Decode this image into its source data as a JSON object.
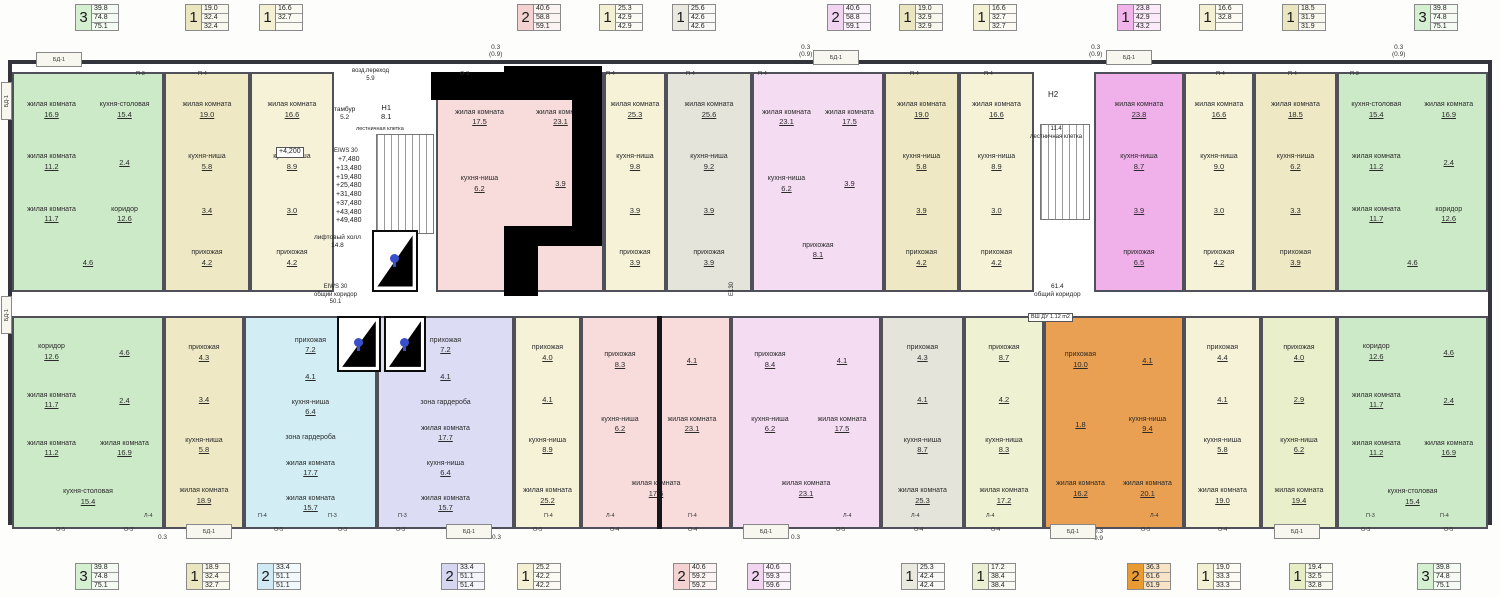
{
  "colors": {
    "green": "#d5efd1",
    "tan": "#eae6c0",
    "cream": "#f3f0d4",
    "pink": "#f4d2d2",
    "gray": "#e9e9e0",
    "violet": "#f1d4ef",
    "magenta": "#f0b4ea",
    "cyan": "#cfeaf2",
    "lavender": "#d6d6f0",
    "olive": "#eaefd2",
    "orange": "#e89b33",
    "lightgreen": "#e6edc4",
    "wall": "#34343c"
  },
  "top_stats": [
    {
      "rooms": "3",
      "values": [
        "39.8",
        "74.8",
        "75.1"
      ],
      "color": "#d5efd1"
    },
    {
      "rooms": "1",
      "values": [
        "19.0",
        "32.4",
        "32.4"
      ],
      "color": "#eae6c0"
    },
    {
      "rooms": "1",
      "values": [
        "16.6",
        "32.7",
        ""
      ],
      "color": "#f3f0d4"
    },
    {
      "rooms": "2",
      "values": [
        "40.6",
        "58.8",
        "59.1"
      ],
      "color": "#f4d2d2"
    },
    {
      "rooms": "1",
      "values": [
        "25.3",
        "42.9",
        "42.9"
      ],
      "color": "#f3f0d4"
    },
    {
      "rooms": "1",
      "values": [
        "25.6",
        "42.6",
        "42.6"
      ],
      "color": "#e9e9e0"
    },
    {
      "rooms": "2",
      "values": [
        "40.6",
        "58.8",
        "59.1"
      ],
      "color": "#f1d4ef"
    },
    {
      "rooms": "1",
      "values": [
        "19.0",
        "32.9",
        "32.9"
      ],
      "color": "#eae6c0"
    },
    {
      "rooms": "1",
      "values": [
        "16.6",
        "32.7",
        "32.7"
      ],
      "color": "#f3f0d4"
    },
    {
      "rooms": "1",
      "values": [
        "23.8",
        "42.9",
        "43.2"
      ],
      "color": "#f0b4ea"
    },
    {
      "rooms": "1",
      "values": [
        "16.6",
        "32.8",
        ""
      ],
      "color": "#f3f0d4"
    },
    {
      "rooms": "1",
      "values": [
        "18.5",
        "31.9",
        "31.9"
      ],
      "color": "#eae6c0"
    },
    {
      "rooms": "3",
      "values": [
        "39.8",
        "74.8",
        "75.1"
      ],
      "color": "#d5efd1"
    }
  ],
  "bottom_stats": [
    {
      "rooms": "3",
      "values": [
        "39.8",
        "74.8",
        "75.1"
      ],
      "color": "#d5efd1"
    },
    {
      "rooms": "1",
      "values": [
        "18.9",
        "32.4",
        "32.7"
      ],
      "color": "#eae6c0"
    },
    {
      "rooms": "2",
      "values": [
        "33.4",
        "51.1",
        "51.1"
      ],
      "color": "#cfeaf2"
    },
    {
      "rooms": "2",
      "values": [
        "33.4",
        "51.1",
        "51.4"
      ],
      "color": "#d6d6f0"
    },
    {
      "rooms": "1",
      "values": [
        "25.2",
        "42.2",
        "42.2"
      ],
      "color": "#f3f0d4"
    },
    {
      "rooms": "2",
      "values": [
        "40.6",
        "59.2",
        "59.2"
      ],
      "color": "#f4d2d2"
    },
    {
      "rooms": "2",
      "values": [
        "40.6",
        "59.3",
        "59.6"
      ],
      "color": "#f1d4ef"
    },
    {
      "rooms": "1",
      "values": [
        "25.3",
        "42.4",
        "42.4"
      ],
      "color": "#e9e9e0"
    },
    {
      "rooms": "1",
      "values": [
        "17.2",
        "38.4",
        "38.4"
      ],
      "color": "#eaefd2"
    },
    {
      "rooms": "2",
      "values": [
        "36.3",
        "61.6",
        "61.9"
      ],
      "color": "#e89b33"
    },
    {
      "rooms": "1",
      "values": [
        "19.0",
        "33.3",
        "33.3"
      ],
      "color": "#f3f0d4"
    },
    {
      "rooms": "1",
      "values": [
        "19.4",
        "32.5",
        "32.8"
      ],
      "color": "#e6edc4"
    },
    {
      "rooms": "3",
      "values": [
        "39.8",
        "74.8",
        "75.1"
      ],
      "color": "#d5efd1"
    }
  ],
  "plan": {
    "apartments_top": [
      {
        "color": "#cdeac8",
        "rooms": [
          {
            "n": "жилая комната",
            "a": "16.9"
          },
          {
            "n": "кухня-столовая",
            "a": "15.4"
          },
          {
            "n": "жилая комната",
            "a": "11.2"
          },
          {
            "n": "",
            "a": "2.4"
          },
          {
            "n": "жилая комната",
            "a": "11.7"
          },
          {
            "n": "коридор",
            "a": "12.6"
          },
          {
            "n": "",
            "a": "4.6"
          }
        ]
      },
      {
        "color": "#eee9c4",
        "rooms": [
          {
            "n": "жилая комната",
            "a": "19.0"
          },
          {
            "n": "кухня-ниша",
            "a": "5.8"
          },
          {
            "n": "",
            "a": "3.4"
          },
          {
            "n": "прихожая",
            "a": "4.2"
          }
        ]
      },
      {
        "color": "#f5f2d8",
        "rooms": [
          {
            "n": "жилая комната",
            "a": "16.6"
          },
          {
            "n": "кухня-ниша",
            "a": "8.9"
          },
          {
            "n": "",
            "a": "3.0"
          },
          {
            "n": "прихожая",
            "a": "4.2"
          }
        ]
      },
      {
        "color": "#f8dcdc",
        "rooms": [
          {
            "n": "жилая комната",
            "a": "17.5"
          },
          {
            "n": "жилая комната",
            "a": "23.1"
          },
          {
            "n": "кухня-ниша",
            "a": "6.2"
          },
          {
            "n": "",
            "a": "3.9"
          },
          {
            "n": "прихожая",
            "a": "8.1"
          }
        ]
      },
      {
        "color": "#f5f2d8",
        "rooms": [
          {
            "n": "жилая комната",
            "a": "25.3"
          },
          {
            "n": "кухня-ниша",
            "a": "9.8"
          },
          {
            "n": "",
            "a": "3.9"
          },
          {
            "n": "прихожая",
            "a": "3.9"
          }
        ]
      },
      {
        "color": "#e4e4da",
        "rooms": [
          {
            "n": "жилая комната",
            "a": "25.6"
          },
          {
            "n": "кухня-ниша",
            "a": "9.2"
          },
          {
            "n": "",
            "a": "3.9"
          },
          {
            "n": "прихожая",
            "a": "3.9"
          }
        ]
      },
      {
        "color": "#f4dcf2",
        "rooms": [
          {
            "n": "жилая комната",
            "a": "23.1"
          },
          {
            "n": "жилая комната",
            "a": "17.5"
          },
          {
            "n": "кухня-ниша",
            "a": "6.2"
          },
          {
            "n": "",
            "a": "3.9"
          },
          {
            "n": "прихожая",
            "a": "8.1"
          }
        ]
      },
      {
        "color": "#eee9c4",
        "rooms": [
          {
            "n": "жилая комната",
            "a": "19.0"
          },
          {
            "n": "кухня-ниша",
            "a": "5.8"
          },
          {
            "n": "",
            "a": "3.9"
          },
          {
            "n": "прихожая",
            "a": "4.2"
          }
        ]
      },
      {
        "color": "#f5f2d8",
        "rooms": [
          {
            "n": "жилая комната",
            "a": "16.6"
          },
          {
            "n": "кухня-ниша",
            "a": "8.9"
          },
          {
            "n": "",
            "a": "3.0"
          },
          {
            "n": "прихожая",
            "a": "4.2"
          }
        ]
      },
      {
        "color": "#f0b0ea",
        "rooms": [
          {
            "n": "жилая комната",
            "a": "23.8"
          },
          {
            "n": "кухня-ниша",
            "a": "8.7"
          },
          {
            "n": "",
            "a": "3.9"
          },
          {
            "n": "прихожая",
            "a": "6.5"
          }
        ]
      },
      {
        "color": "#f5f2d8",
        "rooms": [
          {
            "n": "жилая комната",
            "a": "16.6"
          },
          {
            "n": "кухня-ниша",
            "a": "9.0"
          },
          {
            "n": "",
            "a": "3.0"
          },
          {
            "n": "прихожая",
            "a": "4.2"
          }
        ]
      },
      {
        "color": "#eee9c4",
        "rooms": [
          {
            "n": "жилая комната",
            "a": "18.5"
          },
          {
            "n": "кухня-ниша",
            "a": "6.2"
          },
          {
            "n": "",
            "a": "3.3"
          },
          {
            "n": "прихожая",
            "a": "3.9"
          }
        ]
      },
      {
        "color": "#cdeac8",
        "rooms": [
          {
            "n": "кухня-столовая",
            "a": "15.4"
          },
          {
            "n": "жилая комната",
            "a": "16.9"
          },
          {
            "n": "жилая комната",
            "a": "11.2"
          },
          {
            "n": "",
            "a": "2.4"
          },
          {
            "n": "жилая комната",
            "a": "11.7"
          },
          {
            "n": "коридор",
            "a": "12.6"
          },
          {
            "n": "",
            "a": "4.6"
          }
        ]
      }
    ],
    "apartments_bottom": [
      {
        "color": "#cdeac8",
        "rooms": [
          {
            "n": "коридор",
            "a": "12.6"
          },
          {
            "n": "",
            "a": "4.6"
          },
          {
            "n": "жилая комната",
            "a": "11.7"
          },
          {
            "n": "",
            "a": "2.4"
          },
          {
            "n": "жилая комната",
            "a": "11.2"
          },
          {
            "n": "жилая комната",
            "a": "16.9"
          },
          {
            "n": "кухня-столовая",
            "a": "15.4"
          }
        ]
      },
      {
        "color": "#eee9c4",
        "rooms": [
          {
            "n": "прихожая",
            "a": "4.3"
          },
          {
            "n": "",
            "a": "3.4"
          },
          {
            "n": "кухня-ниша",
            "a": "5.8"
          },
          {
            "n": "жилая комната",
            "a": "18.9"
          }
        ]
      },
      {
        "color": "#d3edf4",
        "rooms": [
          {
            "n": "прихожая",
            "a": "7.2"
          },
          {
            "n": "",
            "a": "4.1"
          },
          {
            "n": "кухня-ниша",
            "a": "6.4"
          },
          {
            "n": "зона гардероба",
            "a": ""
          },
          {
            "n": "жилая комната",
            "a": "17.7"
          },
          {
            "n": "жилая комната",
            "a": "15.7"
          }
        ]
      },
      {
        "color": "#dcdcf4",
        "rooms": [
          {
            "n": "прихожая",
            "a": "7.2"
          },
          {
            "n": "",
            "a": "4.1"
          },
          {
            "n": "зона гардероба",
            "a": ""
          },
          {
            "n": "жилая комната",
            "a": "17.7"
          },
          {
            "n": "кухня-ниша",
            "a": "6.4"
          },
          {
            "n": "жилая комната",
            "a": "15.7"
          }
        ]
      },
      {
        "color": "#f5f2d8",
        "rooms": [
          {
            "n": "прихожая",
            "a": "4.0"
          },
          {
            "n": "",
            "a": "4.1"
          },
          {
            "n": "кухня-ниша",
            "a": "8.9"
          },
          {
            "n": "жилая комната",
            "a": "25.2"
          }
        ]
      },
      {
        "color": "#f8dcdc",
        "rooms": [
          {
            "n": "прихожая",
            "a": "8.3"
          },
          {
            "n": "",
            "a": "4.1"
          },
          {
            "n": "кухня-ниша",
            "a": "6.2"
          },
          {
            "n": "жилая комната",
            "a": "23.1"
          },
          {
            "n": "жилая комната",
            "a": "17.5"
          }
        ]
      },
      {
        "color": "#f4dcf2",
        "rooms": [
          {
            "n": "прихожая",
            "a": "8.4"
          },
          {
            "n": "",
            "a": "4.1"
          },
          {
            "n": "кухня-ниша",
            "a": "6.2"
          },
          {
            "n": "жилая комната",
            "a": "17.5"
          },
          {
            "n": "жилая комната",
            "a": "23.1"
          }
        ]
      },
      {
        "color": "#e4e4da",
        "rooms": [
          {
            "n": "прихожая",
            "a": "4.3"
          },
          {
            "n": "",
            "a": "4.1"
          },
          {
            "n": "кухня-ниша",
            "a": "8.7"
          },
          {
            "n": "жилая комната",
            "a": "25.3"
          }
        ]
      },
      {
        "color": "#eef1d2",
        "rooms": [
          {
            "n": "прихожая",
            "a": "8.7"
          },
          {
            "n": "",
            "a": "4.2"
          },
          {
            "n": "кухня-ниша",
            "a": "8.3"
          },
          {
            "n": "жилая комната",
            "a": "17.2"
          }
        ]
      },
      {
        "color": "#e9a052",
        "rooms": [
          {
            "n": "прихожая",
            "a": "10.0"
          },
          {
            "n": "",
            "a": "4.1"
          },
          {
            "n": "",
            "a": "1.8"
          },
          {
            "n": "кухня-ниша",
            "a": "9.4"
          },
          {
            "n": "жилая комната",
            "a": "16.2"
          },
          {
            "n": "жилая комната",
            "a": "20.1"
          }
        ]
      },
      {
        "color": "#f5f2d8",
        "rooms": [
          {
            "n": "прихожая",
            "a": "4.4"
          },
          {
            "n": "",
            "a": "4.1"
          },
          {
            "n": "кухня-ниша",
            "a": "5.8"
          },
          {
            "n": "жилая комната",
            "a": "19.0"
          }
        ]
      },
      {
        "color": "#e9efca",
        "rooms": [
          {
            "n": "прихожая",
            "a": "4.0"
          },
          {
            "n": "",
            "a": "2.9"
          },
          {
            "n": "кухня-ниша",
            "a": "6.2"
          },
          {
            "n": "жилая комната",
            "a": "19.4"
          }
        ]
      },
      {
        "color": "#cdeac8",
        "rooms": [
          {
            "n": "коридор",
            "a": "12.6"
          },
          {
            "n": "",
            "a": "4.6"
          },
          {
            "n": "жилая комната",
            "a": "11.7"
          },
          {
            "n": "",
            "a": "2.4"
          },
          {
            "n": "жилая комната",
            "a": "11.2"
          },
          {
            "n": "жилая комната",
            "a": "16.9"
          },
          {
            "n": "кухня-столовая",
            "a": "15.4"
          }
        ]
      }
    ],
    "labels": [
      {
        "text": "возд.переход\n5.9"
      },
      {
        "text": "тамбур\n5.2"
      },
      {
        "text": "Н1\n8.1"
      },
      {
        "text": "лестничная клетка"
      },
      {
        "text": "EIWS 30"
      },
      {
        "text": "+7,480\n+13,480\n+19,480\n+25,480\n+31,480\n+37,480\n+43,480\n+49,480"
      },
      {
        "text": "+4,200"
      },
      {
        "text": "лифтовый холл\n14.8"
      },
      {
        "text": "EIWS 30\nобщий коридор\n50.1"
      },
      {
        "text": "Н2"
      },
      {
        "text": "11.4\nлестничная клетка"
      },
      {
        "text": "61.4\nобщий коридор"
      },
      {
        "text": "ВШ ДУ  1.12 m2"
      },
      {
        "text": "Е130"
      }
    ],
    "dims": [
      {
        "text": "0.3\n(0.9)"
      },
      {
        "text": "0.3\n(0.9)"
      },
      {
        "text": "0.3\n(0.9)"
      },
      {
        "text": "0.3\n(0.9)"
      },
      {
        "text": "0.3"
      },
      {
        "text": "0.3"
      },
      {
        "text": "0.3"
      },
      {
        "text": "0.3\n0.9"
      }
    ],
    "tags": [
      {
        "t": "П-3"
      },
      {
        "t": "П-4"
      },
      {
        "t": "О-3"
      },
      {
        "t": "П-4"
      },
      {
        "t": "П-4"
      },
      {
        "t": "П-4"
      },
      {
        "t": "П-4"
      },
      {
        "t": "П-4"
      },
      {
        "t": "П-4"
      },
      {
        "t": "П-4"
      },
      {
        "t": "П-3"
      },
      {
        "t": "Л-4"
      },
      {
        "t": "П-4"
      },
      {
        "t": "П-3"
      },
      {
        "t": "П-3"
      },
      {
        "t": "П-4"
      },
      {
        "t": "Л-4"
      },
      {
        "t": "П-4"
      },
      {
        "t": "Л-4"
      },
      {
        "t": "Л-4"
      },
      {
        "t": "Л-4"
      },
      {
        "t": "Л-4"
      },
      {
        "t": "П-3"
      },
      {
        "t": "П-4"
      },
      {
        "t": "О-5"
      },
      {
        "t": "О-3"
      },
      {
        "t": "О-5"
      },
      {
        "t": "О-3"
      },
      {
        "t": "О-3"
      },
      {
        "t": "О-5"
      },
      {
        "t": "О-4"
      },
      {
        "t": "О-4"
      },
      {
        "t": "О-5"
      },
      {
        "t": "О-4"
      },
      {
        "t": "О-4"
      },
      {
        "t": "О-5"
      },
      {
        "t": "О-4"
      },
      {
        "t": "О-3"
      },
      {
        "t": "О-5"
      }
    ],
    "balcony_tag": "БД-1"
  }
}
